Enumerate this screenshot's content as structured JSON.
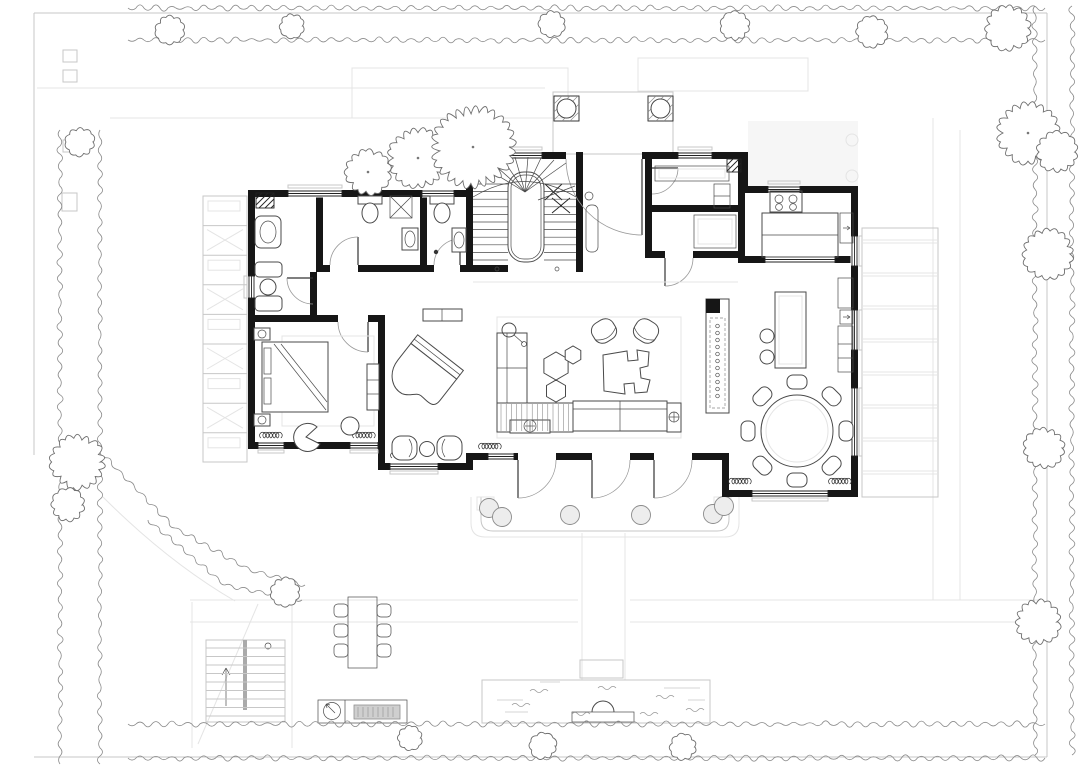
{
  "meta": {
    "title": "Ground-floor plan of a villa with landscaped garden",
    "type": "architectural floor plan / site plan",
    "visible_text": []
  },
  "palette": {
    "paper": "#ffffff",
    "wall_ink": "#161616",
    "furniture_line": "#4a4a4a",
    "light_line": "#c7c7c7",
    "faint_line": "#e4e4e4",
    "hedge_line": "#8b8b8b",
    "tree_line": "#6e6e6e",
    "deck_fill": "#f6f6f6",
    "grill_fill": "#cfcfcf"
  },
  "rooms": [
    {
      "id": "entry-porch",
      "label": "Entry porch with two round columns"
    },
    {
      "id": "entry-hall",
      "label": "Entry hall"
    },
    {
      "id": "staircase",
      "label": "U-shaped staircase around central core"
    },
    {
      "id": "closet",
      "label": "Closet / utility with basin"
    },
    {
      "id": "bathroom-1",
      "label": "Bathroom with WC and shower"
    },
    {
      "id": "bathroom-2",
      "label": "Bathroom with WC and basin"
    },
    {
      "id": "wardrobe",
      "label": "Wardrobe passage"
    },
    {
      "id": "master-bedroom",
      "label": "Master bedroom"
    },
    {
      "id": "sitting-nook",
      "label": "Sitting nook with two lounge chairs"
    },
    {
      "id": "living-room",
      "label": "Living room"
    },
    {
      "id": "pantry",
      "label": "Pantry / laundry"
    },
    {
      "id": "mudroom",
      "label": "Mud room / storage"
    },
    {
      "id": "kitchen",
      "label": "Kitchen with island and cooktop"
    },
    {
      "id": "dining-room",
      "label": "Dining area with round table"
    },
    {
      "id": "south-terrace",
      "label": "South terrace with round columns"
    },
    {
      "id": "west-deck",
      "label": "West trellis deck"
    },
    {
      "id": "east-deck",
      "label": "East timber deck"
    },
    {
      "id": "rear-courtyard",
      "label": "Rear courtyard"
    },
    {
      "id": "outdoor-dining",
      "label": "Outdoor dining area"
    },
    {
      "id": "outdoor-kitchen",
      "label": "Outdoor BBQ counter"
    },
    {
      "id": "water-feature",
      "label": "Pond with sculpture"
    },
    {
      "id": "exterior-stair",
      "label": "Exterior garden staircase"
    },
    {
      "id": "garden",
      "label": "Garden with hedge border and trees"
    }
  ],
  "furniture": [
    {
      "id": "double-bed",
      "label": "Double bed with nightstands"
    },
    {
      "id": "bedroom-chair",
      "label": "Bedroom armchair with side table"
    },
    {
      "id": "tv-cabinet",
      "label": "TV cabinet"
    },
    {
      "id": "wardrobe-units",
      "label": "Wardrobe units and basin"
    },
    {
      "id": "toilet",
      "label": "Toilets (2)"
    },
    {
      "id": "shower",
      "label": "Shower with cross hatch"
    },
    {
      "id": "grand-piano",
      "label": "Grand piano"
    },
    {
      "id": "l-sofa",
      "label": "L-shaped sofa with striped chaise"
    },
    {
      "id": "hex-tables",
      "label": "Hexagonal coffee tables (3)"
    },
    {
      "id": "organic-table",
      "label": "Organic-shaped coffee table"
    },
    {
      "id": "armchairs",
      "label": "Pair of armchairs"
    },
    {
      "id": "floor-lamp",
      "label": "Floor lamp"
    },
    {
      "id": "console",
      "label": "Console table"
    },
    {
      "id": "kitchen-island",
      "label": "Kitchen island"
    },
    {
      "id": "cooktop",
      "label": "Four-burner cooktop"
    },
    {
      "id": "bar-island",
      "label": "Bar island with two stools"
    },
    {
      "id": "sideboard",
      "label": "Sideboard buffet"
    },
    {
      "id": "tall-cabinets",
      "label": "Tall cabinet wall"
    },
    {
      "id": "dining-table",
      "label": "Round dining table with 8 chairs"
    },
    {
      "id": "outdoor-table",
      "label": "Outdoor table with 6 chairs"
    },
    {
      "id": "bbq",
      "label": "BBQ counter with grill and sink"
    },
    {
      "id": "fountain",
      "label": "Fountain sculpture on plinth"
    }
  ],
  "landscape": {
    "hedge_sides": [
      "top",
      "left",
      "right",
      "bottom",
      "curved south-west"
    ],
    "tree_count": 21,
    "decks": [
      "west trellis deck",
      "east deck",
      "south terrace",
      "entry porch"
    ],
    "paths": [
      "upper driveway lines",
      "lower garden path band",
      "axial path to pond"
    ]
  }
}
